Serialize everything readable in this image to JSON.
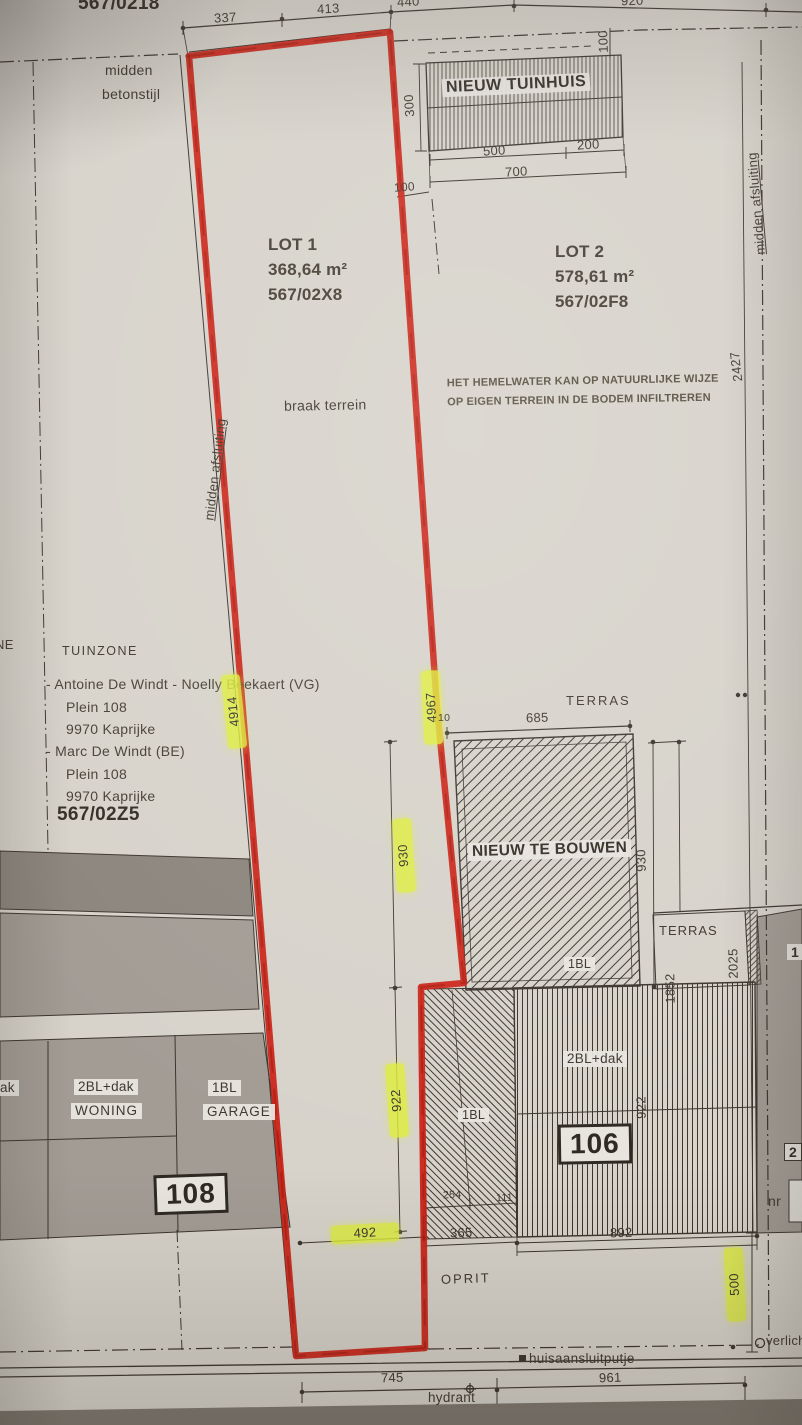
{
  "colors": {
    "red": "#cb2013",
    "highlight": "#dfee3a",
    "paper": "#d7d3cb",
    "parcel_grey": "#a39c95",
    "parcel_dark": "#8b857d",
    "ink": "#3b352e"
  },
  "top": {
    "ref": "567/0218",
    "d337": "337",
    "d413": "413",
    "d440": "440",
    "d920": "920",
    "fence1": "midden",
    "fence2": "betonstijl"
  },
  "tuinhuis": {
    "label": "NIEUW TUINHUIS",
    "d500": "500",
    "d200": "200",
    "d700": "700",
    "d300": "300",
    "d100_top": "100",
    "d100_left": "100"
  },
  "lot1": {
    "title": "LOT 1",
    "area": "368,64 m²",
    "ref": "567/02X8",
    "terrain": "braak terrein",
    "boundary": "midden afsluiting",
    "d4914": "4914",
    "d4967": "4967"
  },
  "lot2": {
    "title": "LOT 2",
    "area": "578,61 m²",
    "ref": "567/02F8",
    "note1": "HET HEMELWATER KAN OP NATUURLIJKE WIJZE",
    "note2": "OP EIGEN TERREIN IN DE BODEM INFILTREREN",
    "boundary": "midden afsluiting",
    "d2427": "2427"
  },
  "owners": {
    "zone": "TUINZONE",
    "frag_ne": "NE",
    "lines": [
      "- Antoine De Windt - Noelly Beekaert (VG)",
      "Plein 108",
      "9970 Kaprijke",
      "- Marc De Windt (BE)",
      "Plein 108",
      "9970 Kaprijke"
    ],
    "ref": "567/02Z5"
  },
  "building": {
    "label": "NIEUW TE BOUWEN",
    "terras": "TERRAS",
    "d10": "10",
    "d685": "685",
    "d930_left": "930",
    "d930_right": "930",
    "floor": "1BL"
  },
  "terras_right": {
    "label": "TERRAS",
    "d2025": "2025",
    "d1852": "1852"
  },
  "house106": {
    "type": "2BL+dak",
    "nr": "106",
    "d922": "922",
    "d892": "892"
  },
  "neighbor_right": {
    "frag_1": "1",
    "frag_2": "2",
    "frag_nr": "nr"
  },
  "driveway": {
    "floor": "1BL",
    "d254": "254",
    "d111": "111",
    "d922": "922",
    "d492": "492",
    "d365": "365",
    "oprit": "OPRIT"
  },
  "house108": {
    "frag_dak": "ak",
    "type_woning": "2BL+dak",
    "woning": "WONING",
    "type_garage": "1BL",
    "garage": "GARAGE",
    "nr": "108"
  },
  "street": {
    "d745": "745",
    "d961": "961",
    "hydrant": "hydrant",
    "putje": "huisaansluitputje",
    "d500": "500",
    "verlich": "verlich"
  }
}
